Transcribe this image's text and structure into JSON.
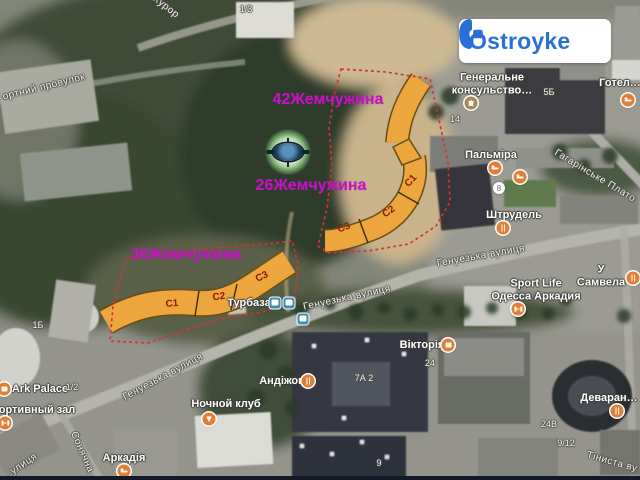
{
  "logo": {
    "text": "Ostroyke",
    "color": "#2a6fd6"
  },
  "colors": {
    "highlight": "#eda63e",
    "boundary": "#d23530",
    "pearl_label": "#c414c4",
    "section_text": "#8c1a04"
  },
  "pearls": [
    {
      "text": "42Жемчужина",
      "x": 328,
      "y": 100
    },
    {
      "text": "26Жемчужина",
      "x": 311,
      "y": 186
    },
    {
      "text": "36Жемчужина",
      "x": 186,
      "y": 255
    }
  ],
  "sections": [
    {
      "text": "C1",
      "x": 172,
      "y": 304,
      "rot": -5
    },
    {
      "text": "C2",
      "x": 219,
      "y": 297,
      "rot": -8
    },
    {
      "text": "C3",
      "x": 262,
      "y": 277,
      "rot": -25
    },
    {
      "text": "C1",
      "x": 411,
      "y": 181,
      "rot": -48
    },
    {
      "text": "C2",
      "x": 389,
      "y": 212,
      "rot": -36
    },
    {
      "text": "C3",
      "x": 344,
      "y": 228,
      "rot": -20
    }
  ],
  "streets": [
    {
      "text": "Курор",
      "x": 166,
      "y": 7,
      "rot": 38
    },
    {
      "text": "ортний провулок",
      "x": 44,
      "y": 87,
      "rot": -14
    },
    {
      "text": "Гагарінське Плато",
      "x": 595,
      "y": 176,
      "rot": 31
    },
    {
      "text": "Генуезька вулиця",
      "x": 481,
      "y": 256,
      "rot": -10
    },
    {
      "text": "Генуезька вулиця",
      "x": 347,
      "y": 298,
      "rot": -12
    },
    {
      "text": "Генуезька вулиця",
      "x": 163,
      "y": 377,
      "rot": -28
    },
    {
      "text": "Сонячна",
      "x": 82,
      "y": 452,
      "rot": 66
    },
    {
      "text": "улиця",
      "x": 24,
      "y": 464,
      "rot": -34
    },
    {
      "text": "Тіниста ву",
      "x": 612,
      "y": 462,
      "rot": 16
    }
  ],
  "pois": [
    {
      "text": "Генеральне\nконсульство…",
      "x": 492,
      "y": 84
    },
    {
      "text": "Готел…",
      "x": 620,
      "y": 83
    },
    {
      "text": "Пальміра",
      "x": 491,
      "y": 155
    },
    {
      "text": "Штрудель",
      "x": 514,
      "y": 215
    },
    {
      "text": "Турбаза",
      "x": 249,
      "y": 303
    },
    {
      "text": "У Самвела",
      "x": 601,
      "y": 276
    },
    {
      "text": "Sport Life\nОдесса Аркадия",
      "x": 536,
      "y": 290
    },
    {
      "text": "Вікторія",
      "x": 422,
      "y": 345
    },
    {
      "text": "Андіжон",
      "x": 282,
      "y": 381
    },
    {
      "text": "Ночной клуб",
      "x": 226,
      "y": 404
    },
    {
      "text": "Ark Palace",
      "x": 40,
      "y": 389
    },
    {
      "text": "ортивный зал",
      "x": 37,
      "y": 410
    },
    {
      "text": "Аркадія",
      "x": 124,
      "y": 458
    },
    {
      "text": "Деваран…",
      "x": 609,
      "y": 398
    }
  ],
  "numbers": [
    {
      "text": "1/3",
      "x": 246,
      "y": 9
    },
    {
      "text": "5Б",
      "x": 549,
      "y": 92
    },
    {
      "text": "14",
      "x": 455,
      "y": 119
    },
    {
      "text": "1Б",
      "x": 38,
      "y": 325
    },
    {
      "text": "24",
      "x": 430,
      "y": 363
    },
    {
      "text": "7А 2",
      "x": 364,
      "y": 378
    },
    {
      "text": "1/2",
      "x": 72,
      "y": 387
    },
    {
      "text": "24В",
      "x": 549,
      "y": 424
    },
    {
      "text": "9",
      "x": 379,
      "y": 463
    },
    {
      "text": "9/12",
      "x": 566,
      "y": 443
    },
    {
      "text": "8",
      "x": 499,
      "y": 188,
      "circle": true
    }
  ],
  "markers": [
    {
      "type": "museum",
      "x": 471,
      "y": 103
    },
    {
      "type": "hotel",
      "x": 628,
      "y": 100
    },
    {
      "type": "hotel",
      "x": 495,
      "y": 168
    },
    {
      "type": "hotel",
      "x": 520,
      "y": 177
    },
    {
      "type": "hotel",
      "x": 124,
      "y": 471
    },
    {
      "type": "restaurant",
      "x": 503,
      "y": 228
    },
    {
      "type": "restaurant",
      "x": 633,
      "y": 278
    },
    {
      "type": "restaurant",
      "x": 308,
      "y": 381
    },
    {
      "type": "restaurant",
      "x": 617,
      "y": 411
    },
    {
      "type": "fitness",
      "x": 518,
      "y": 309
    },
    {
      "type": "fitness",
      "x": 5,
      "y": 423
    },
    {
      "type": "store",
      "x": 448,
      "y": 345
    },
    {
      "type": "bar",
      "x": 209,
      "y": 419
    },
    {
      "type": "venue",
      "x": 4,
      "y": 389
    },
    {
      "type": "transit",
      "x": 275,
      "y": 303
    },
    {
      "type": "transit",
      "x": 289,
      "y": 303
    },
    {
      "type": "transit",
      "x": 303,
      "y": 319
    }
  ]
}
